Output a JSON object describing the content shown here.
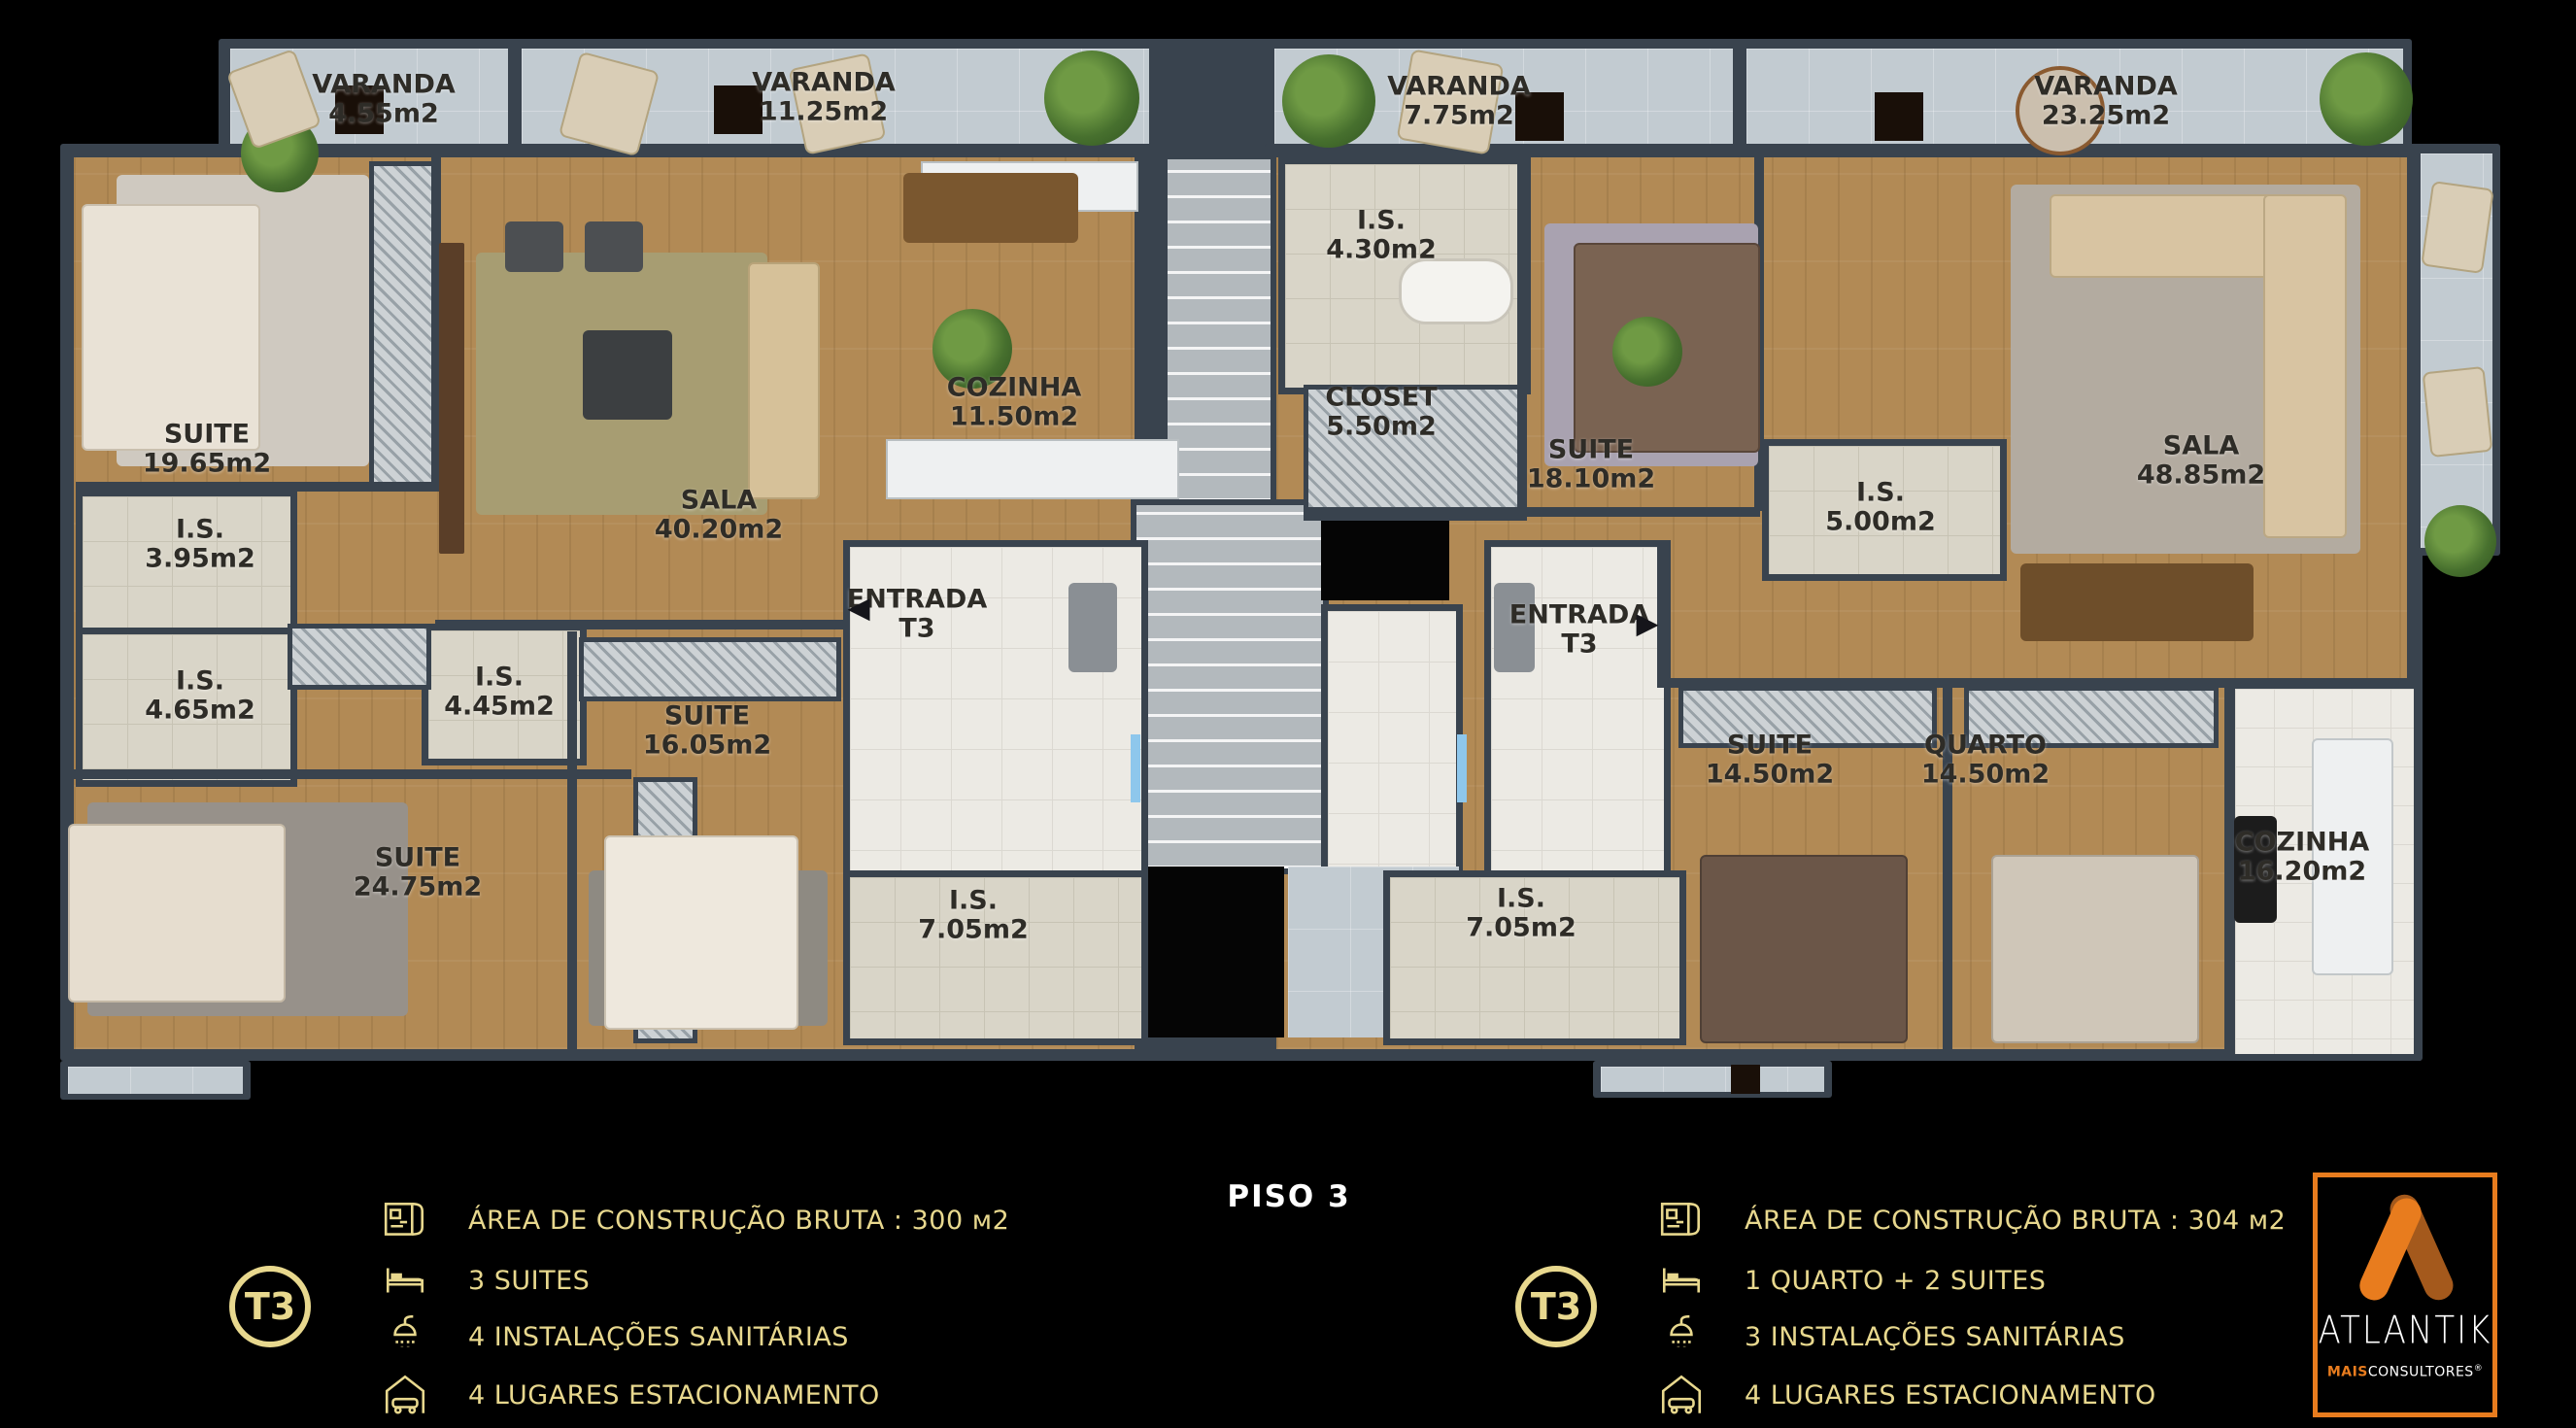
{
  "title": {
    "floor": "PISO 3"
  },
  "colors": {
    "gold": "#e8d88e",
    "orange": "#e87c1e",
    "orangeDark": "#a4591c",
    "wall": "#39434e",
    "ink": "#2e2c27"
  },
  "rooms": {
    "varanda1": {
      "name": "VARANDA",
      "area": "4.55m2"
    },
    "varanda2": {
      "name": "VARANDA",
      "area": "11.25m2"
    },
    "varanda3": {
      "name": "VARANDA",
      "area": "7.75m2"
    },
    "varanda4": {
      "name": "VARANDA",
      "area": "23.25m2"
    },
    "l_suite1": {
      "name": "SUITE",
      "area": "19.65m2"
    },
    "l_is1": {
      "name": "I.S.",
      "area": "3.95m2"
    },
    "l_is2": {
      "name": "I.S.",
      "area": "4.65m2"
    },
    "l_is3": {
      "name": "I.S.",
      "area": "4.45m2"
    },
    "l_suite2": {
      "name": "SUITE",
      "area": "24.75m2"
    },
    "l_suite3": {
      "name": "SUITE",
      "area": "16.05m2"
    },
    "l_sala": {
      "name": "SALA",
      "area": "40.20m2"
    },
    "l_cozinha": {
      "name": "COZINHA",
      "area": "11.50m2"
    },
    "l_entrada": {
      "name": "ENTRADA",
      "area": "T3"
    },
    "l_is4": {
      "name": "I.S.",
      "area": "7.05m2"
    },
    "r_is1": {
      "name": "I.S.",
      "area": "4.30m2"
    },
    "r_closet": {
      "name": "CLOSET",
      "area": "5.50m2"
    },
    "r_suite1": {
      "name": "SUITE",
      "area": "18.10m2"
    },
    "r_is2": {
      "name": "I.S.",
      "area": "5.00m2"
    },
    "r_sala": {
      "name": "SALA",
      "area": "48.85m2"
    },
    "r_entrada": {
      "name": "ENTRADA",
      "area": "T3"
    },
    "r_is3": {
      "name": "I.S.",
      "area": "7.05m2"
    },
    "r_suite2": {
      "name": "SUITE",
      "area": "14.50m2"
    },
    "r_quarto": {
      "name": "QUARTO",
      "area": "14.50m2"
    },
    "r_cozinha": {
      "name": "COZINHA",
      "area": "16.20m2"
    }
  },
  "entrance_arrows": {
    "left": "◀",
    "right": "▶"
  },
  "legend_left": {
    "badge": "T3",
    "items": [
      {
        "icon": "floor-plan-icon",
        "text": "ÁREA DE CONSTRUÇÃO BRUTA :  300 м2"
      },
      {
        "icon": "bed-icon",
        "text": "3 SUITES"
      },
      {
        "icon": "shower-icon",
        "text": "4 INSTALAÇÕES SANITÁRIAS"
      },
      {
        "icon": "garage-icon",
        "text": "4 LUGARES ESTACIONAMENTO"
      }
    ]
  },
  "legend_right": {
    "badge": "T3",
    "items": [
      {
        "icon": "floor-plan-icon",
        "text": "ÁREA DE CONSTRUÇÃO BRUTA :  304 м2"
      },
      {
        "icon": "bed-icon",
        "text": "1 QUARTO + 2 SUITES"
      },
      {
        "icon": "shower-icon",
        "text": "3 INSTALAÇÕES SANITÁRIAS"
      },
      {
        "icon": "garage-icon",
        "text": "4 LUGARES ESTACIONAMENTO"
      }
    ]
  },
  "logo": {
    "brand": "ATLANTIK",
    "sub_accent": "MAIS",
    "sub_rest": "CONSULTORES",
    "registered": "®"
  }
}
